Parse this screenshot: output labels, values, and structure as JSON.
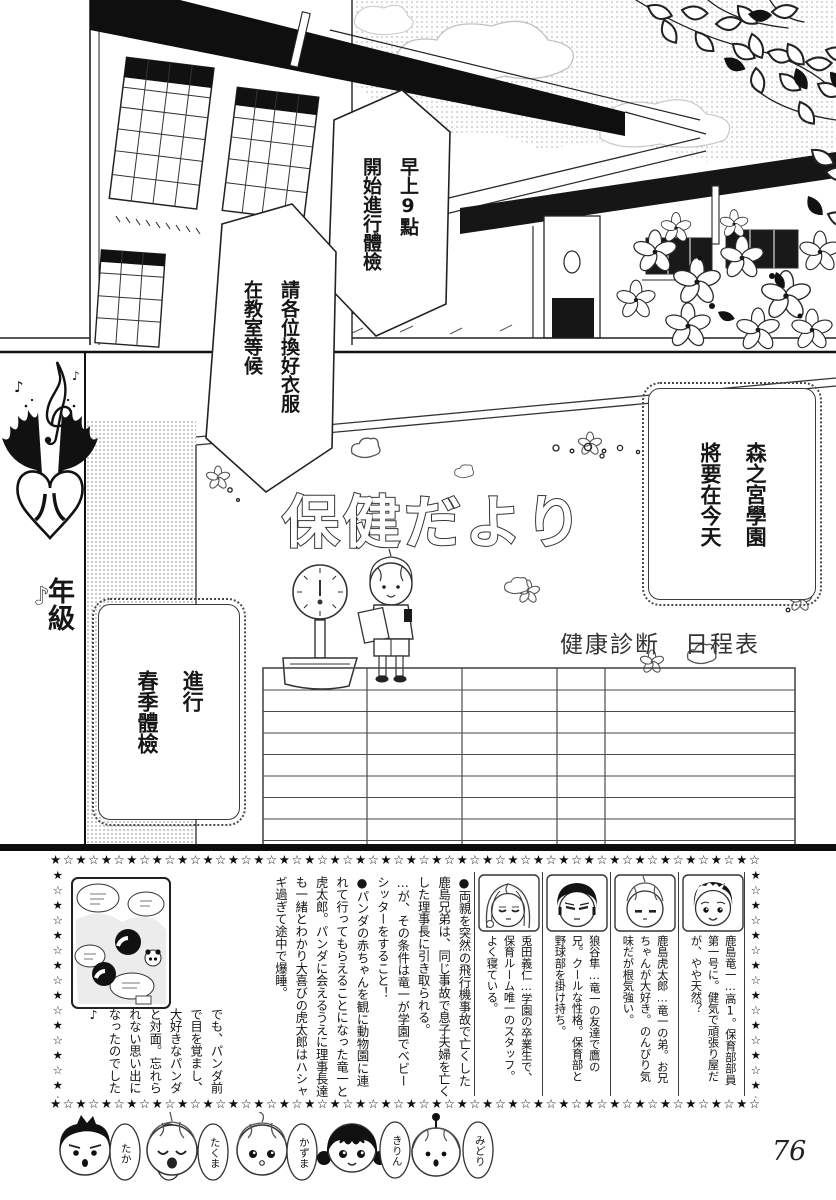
{
  "page_number": "76",
  "top_panel": {
    "bubble_time": "早上9點\n開始進行體檢",
    "bubble_instruction": "請各位換好衣服\n在教室等候"
  },
  "chapter_badge": {
    "grade": "八",
    "suffix": "年級",
    "note": "♪"
  },
  "poster": {
    "title": "保健だより",
    "bubble_school": "森之宮學園\n將要在今天",
    "bubble_checkup": "進行\n春季體檢",
    "schedule_title": "健康診断　日程表",
    "table": {
      "columns": 5,
      "rows": 8
    }
  },
  "footer": {
    "star_unit": "★☆",
    "story_main": "●両親を突然の飛行機事故で亡くした鹿島兄弟は、同じ事故で息子夫婦を亡くした理事長に引き取られる。\n…が、その条件は竜一が学園でベビーシッターをすること！\n●パンダの赤ちゃんを観に動物園に連れて行ってもらえることになった竜一と虎太郎。パンダに会えるうえに理事長達も一緒とわかり大喜びの虎太郎はハシャギ過ぎて途中で爆睡。",
    "story_tail": "でも、パンダ前で目を覚まし、大好きなパンダと対面。忘れられない思い出になったのでした♪",
    "profiles": [
      "鹿島竜一…高1。保育部部員第一号に。健気で頑張り屋だが、やや天然？",
      "鹿島虎太郎…竜一の弟。お兄ちゃんが大好き。のんびり気味だが根気強い。",
      "狼谷隼…竜一の友達で鷹の兄。クールな性格。保育部と野球部を掛け持ち。",
      "兎田義仁…学園の卒業生で、保育ルーム唯一のスタッフ。よく寝ている。"
    ],
    "chibi_names": [
      "たか",
      "たくま",
      "かずま",
      "きりん",
      "みどり"
    ]
  }
}
